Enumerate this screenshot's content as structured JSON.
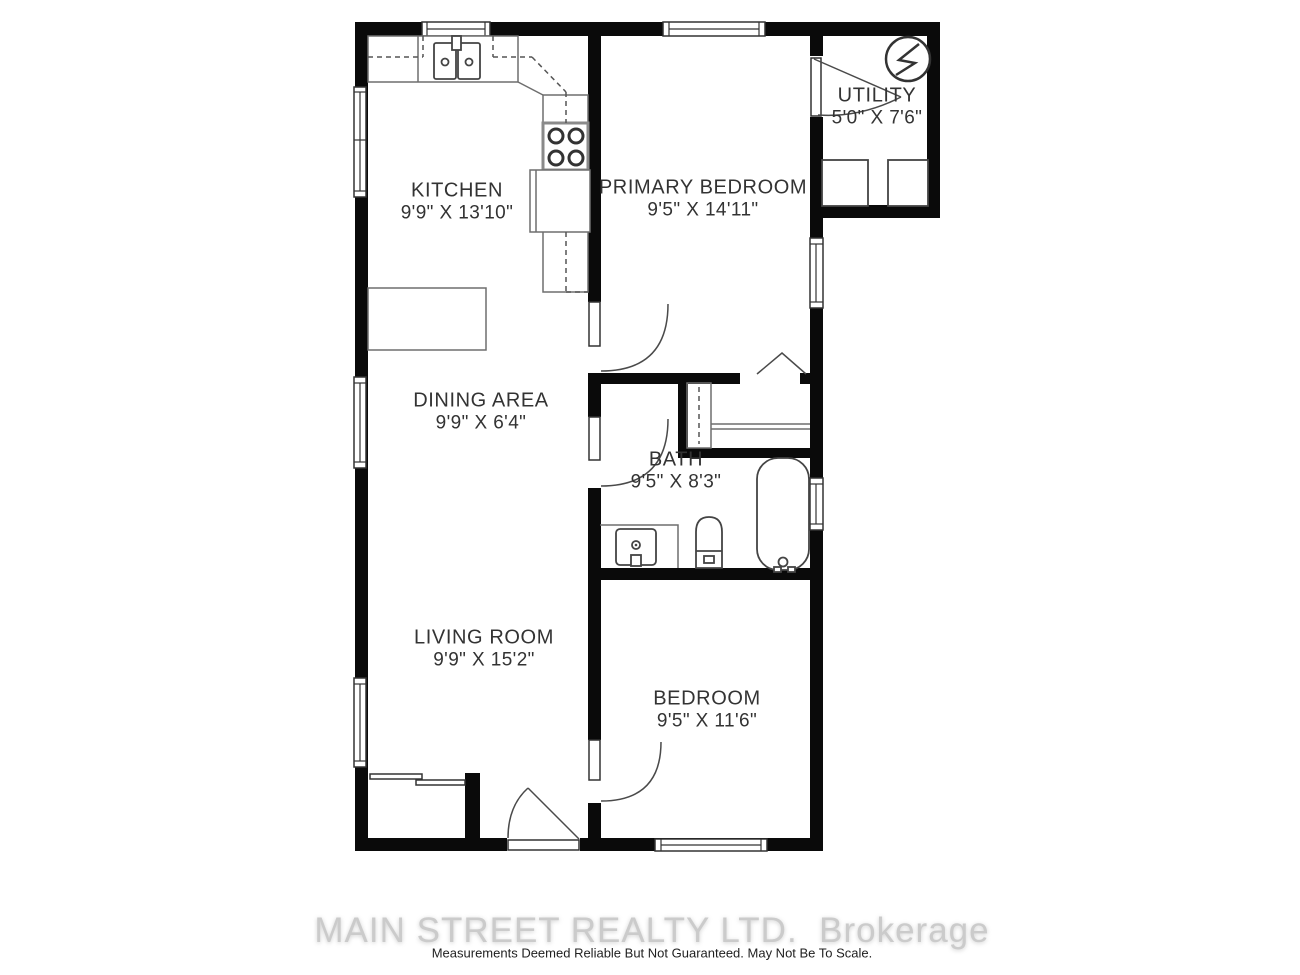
{
  "colors": {
    "wall": "#0a0a0a",
    "fixture_line": "#444444",
    "counter_line": "#6e6e6e",
    "label_text": "#333333",
    "watermark_text": "#cbcbcb",
    "disclaimer_text": "#1f1f1f",
    "background": "#ffffff"
  },
  "rooms": {
    "kitchen": {
      "name": "KITCHEN",
      "dims": "9'9\" X 13'10\""
    },
    "primary_bedroom": {
      "name": "PRIMARY BEDROOM",
      "dims": "9'5\" X 14'11\""
    },
    "utility": {
      "name": "UTILITY",
      "dims": "5'0\" X 7'6\""
    },
    "dining": {
      "name": "DINING AREA",
      "dims": "9'9\" X 6'4\""
    },
    "bath": {
      "name": "BATH",
      "dims": "9'5\" X 8'3\""
    },
    "living": {
      "name": "LIVING ROOM",
      "dims": "9'9\" X 15'2\""
    },
    "bedroom": {
      "name": "BEDROOM",
      "dims": "9'5\" X 11'6\""
    }
  },
  "footer": {
    "watermark": "MAIN STREET REALTY LTD.  Brokerage",
    "disclaimer": "Measurements Deemed Reliable But Not Guaranteed. May Not Be To Scale."
  }
}
